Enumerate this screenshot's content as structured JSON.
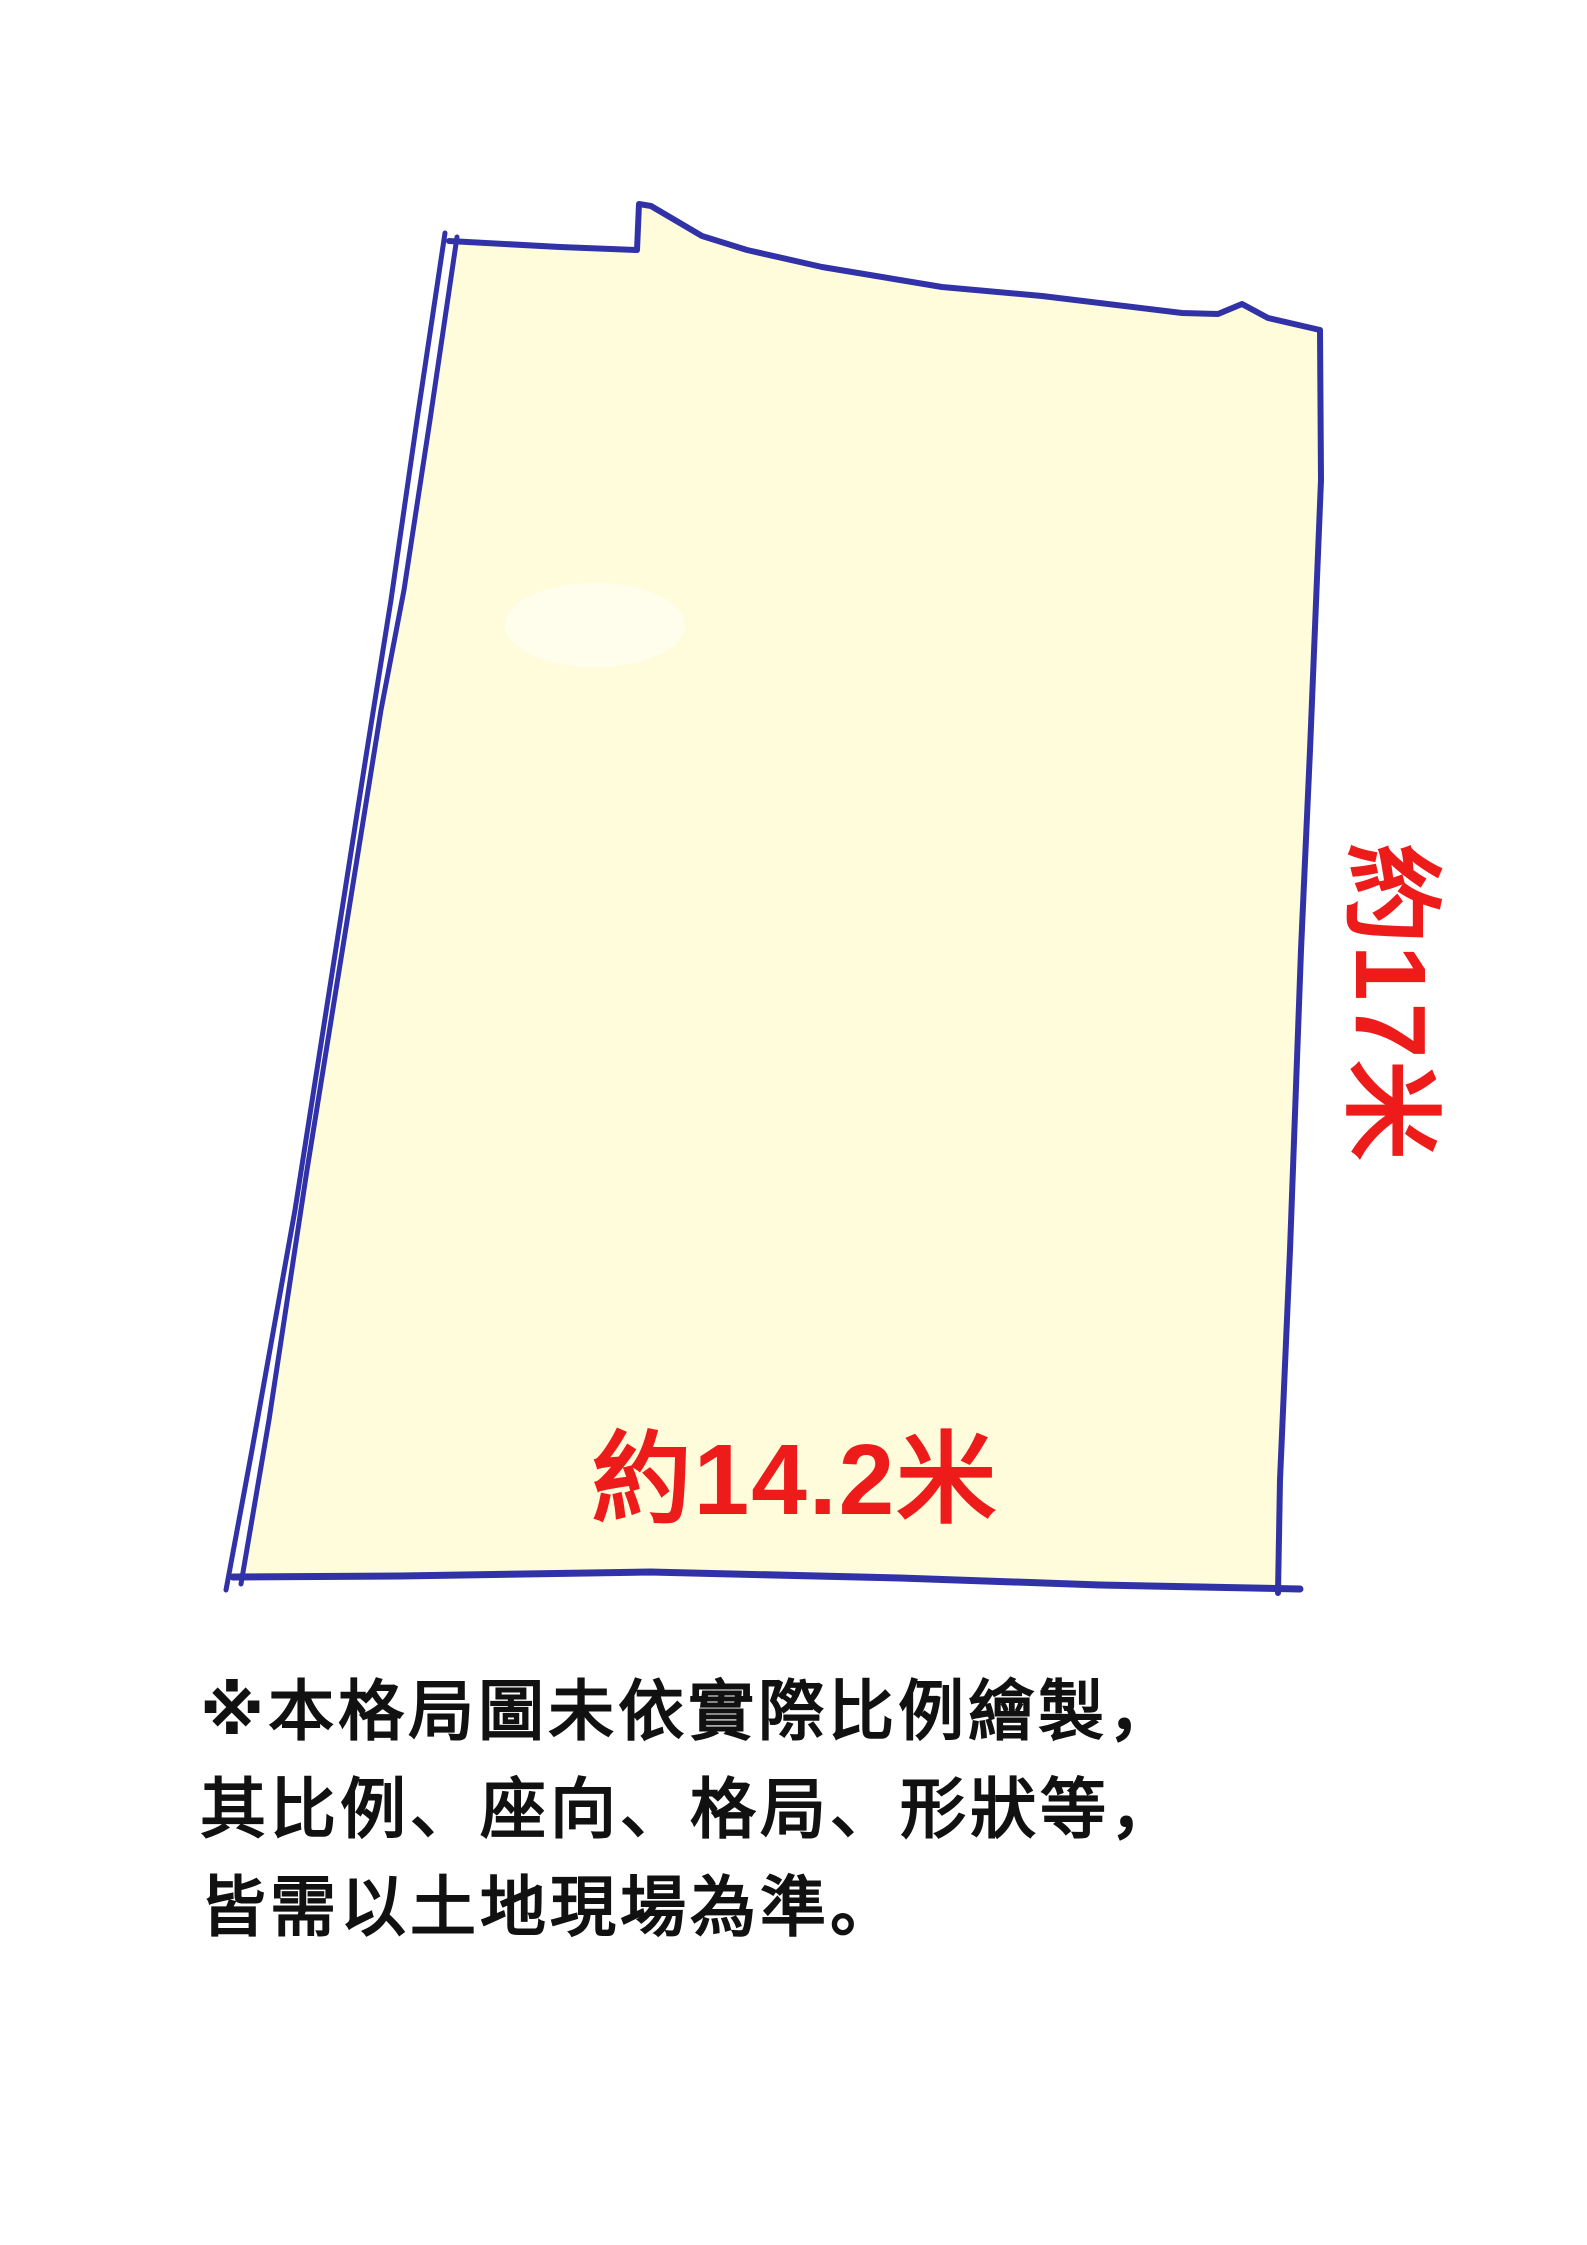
{
  "diagram": {
    "width_label": "約14.2米",
    "height_label": "約17米"
  },
  "disclaimer": {
    "line1": "※本格局圖未依實際比例繪製，",
    "line2": "其比例、座向、格局、形狀等，",
    "line3": "皆需以土地現場為準。"
  },
  "colors": {
    "plot_fill": "#FFFCDB",
    "plot_stroke": "#3232A8",
    "dimension_text": "#EE1B1B",
    "disclaimer_text": "#111111",
    "background": "#FFFFFF"
  }
}
